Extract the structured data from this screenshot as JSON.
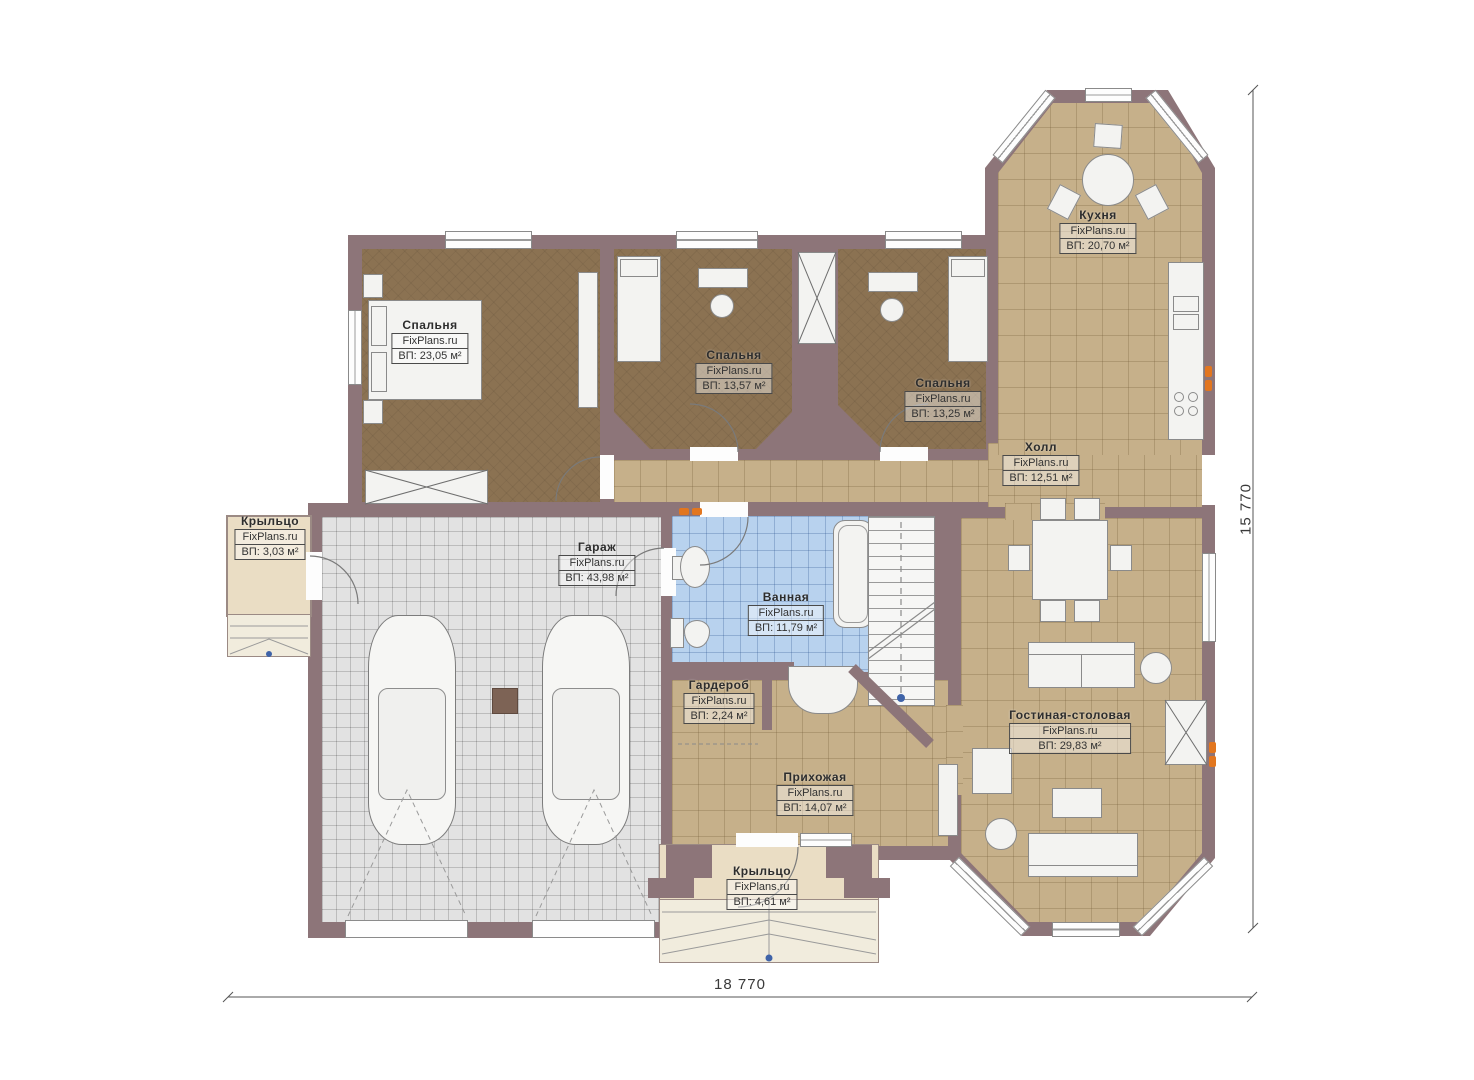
{
  "plan": {
    "type": "floor-plan",
    "brand": "FixPlans.ru"
  },
  "rooms": [
    {
      "name": "Спальня",
      "watermark": "FixPlans.ru",
      "area": "ВП: 23,05 м²"
    },
    {
      "name": "Спальня",
      "watermark": "FixPlans.ru",
      "area": "ВП: 13,57 м²"
    },
    {
      "name": "Спальня",
      "watermark": "FixPlans.ru",
      "area": "ВП: 13,25 м²"
    },
    {
      "name": "Кухня",
      "watermark": "FixPlans.ru",
      "area": "ВП: 20,70 м²"
    },
    {
      "name": "Холл",
      "watermark": "FixPlans.ru",
      "area": "ВП: 12,51 м²"
    },
    {
      "name": "Крыльцо",
      "watermark": "FixPlans.ru",
      "area": "ВП: 3,03 м²"
    },
    {
      "name": "Гараж",
      "watermark": "FixPlans.ru",
      "area": "ВП: 43,98 м²"
    },
    {
      "name": "Ванная",
      "watermark": "FixPlans.ru",
      "area": "ВП: 11,79 м²"
    },
    {
      "name": "Гардероб",
      "watermark": "FixPlans.ru",
      "area": "ВП: 2,24 м²"
    },
    {
      "name": "Прихожая",
      "watermark": "FixPlans.ru",
      "area": "ВП: 14,07 м²"
    },
    {
      "name": "Гостиная-столовая",
      "watermark": "FixPlans.ru",
      "area": "ВП: 29,83 м²"
    },
    {
      "name": "Крыльцо",
      "watermark": "FixPlans.ru",
      "area": "ВП: 4,61 м²"
    }
  ],
  "dimensions": {
    "width_label": "18 770",
    "height_label": "15 770"
  },
  "colors": {
    "wall": "#8d7579",
    "floor_wood": "#8b7252",
    "floor_tile_tan": "#c6b08a",
    "floor_garage": "#e2e2e2",
    "floor_bath": "#b8d2ee",
    "porch": "#eaddc4",
    "accent_radiator": "#e2761f"
  }
}
